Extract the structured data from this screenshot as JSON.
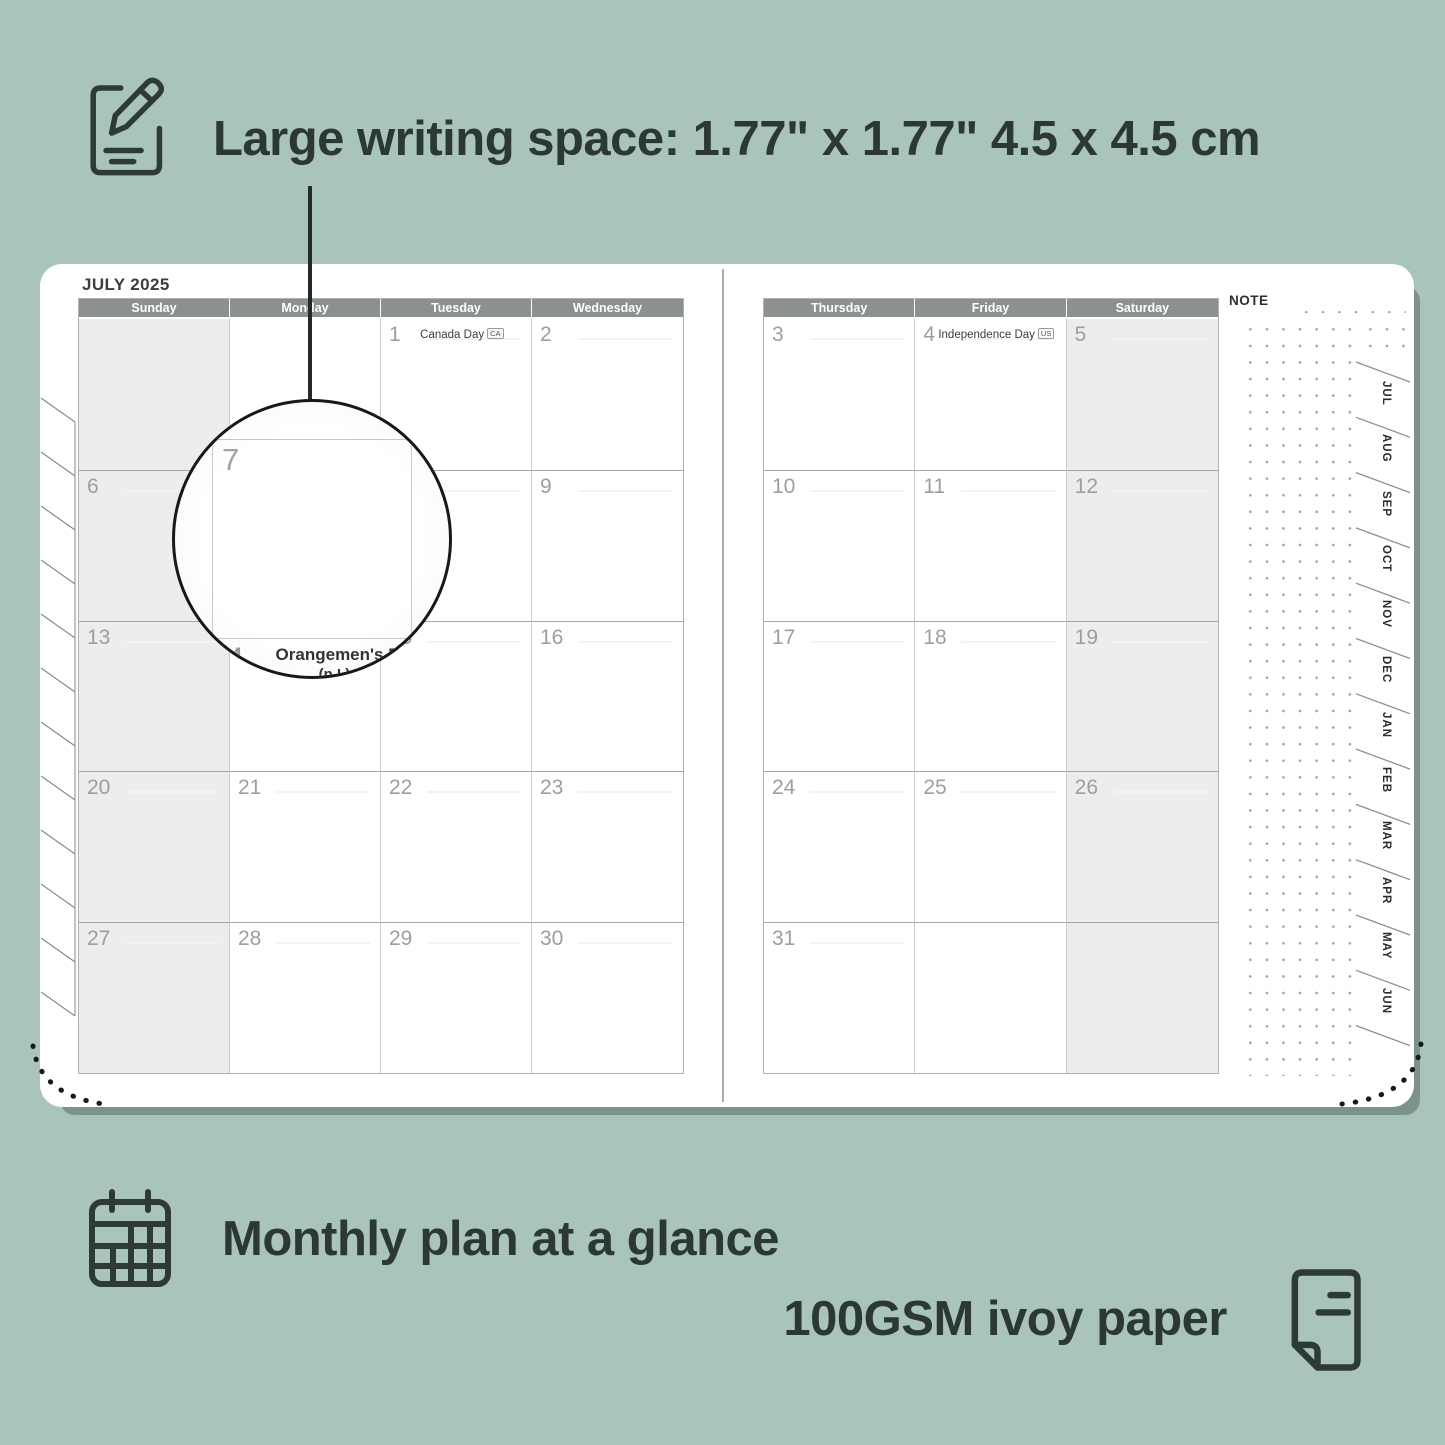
{
  "colors": {
    "background": "#a9c4bc",
    "ink": "#2e3a37",
    "header_bar": "#8b918e",
    "weekend_fill": "#ededed",
    "day_number": "#9e9e9e",
    "page": "#ffffff",
    "page_shadow": "#7c938c"
  },
  "annotations": {
    "top": {
      "icon": "note-pencil-icon",
      "label": "Large writing space: 1.77\" x 1.77\"  4.5 x 4.5 cm"
    },
    "bottom_left": {
      "icon": "calendar-grid-icon",
      "label": "Monthly plan at a glance"
    },
    "bottom_right": {
      "icon": "paper-sheet-icon",
      "label": "100GSM ivoy paper"
    }
  },
  "planner": {
    "month_title": "JULY 2025",
    "note_label": "NOTE",
    "left_day_headers": [
      "Sunday",
      "Monday",
      "Tuesday",
      "Wednesday"
    ],
    "right_day_headers": [
      "Thursday",
      "Friday",
      "Saturday"
    ],
    "left_weeks": [
      [
        {
          "day": "",
          "shaded": true
        },
        {
          "day": ""
        },
        {
          "day": "1",
          "holiday": "Canada Day",
          "badge": "CA"
        },
        {
          "day": "2"
        }
      ],
      [
        {
          "day": "6",
          "shaded": true
        },
        {
          "day": "7"
        },
        {
          "day": "8"
        },
        {
          "day": "9"
        }
      ],
      [
        {
          "day": "13",
          "shaded": true
        },
        {
          "day": "14",
          "holiday": "Orangemen's Day (n.I.)",
          "badge": "UK"
        },
        {
          "day": "15"
        },
        {
          "day": "16"
        }
      ],
      [
        {
          "day": "20",
          "shaded": true
        },
        {
          "day": "21"
        },
        {
          "day": "22"
        },
        {
          "day": "23"
        }
      ],
      [
        {
          "day": "27",
          "shaded": true
        },
        {
          "day": "28"
        },
        {
          "day": "29"
        },
        {
          "day": "30"
        }
      ]
    ],
    "right_weeks": [
      [
        {
          "day": "3"
        },
        {
          "day": "4",
          "holiday": "Independence Day",
          "badge": "US"
        },
        {
          "day": "5",
          "shaded": true
        }
      ],
      [
        {
          "day": "10"
        },
        {
          "day": "11"
        },
        {
          "day": "12",
          "shaded": true
        }
      ],
      [
        {
          "day": "17"
        },
        {
          "day": "18"
        },
        {
          "day": "19",
          "shaded": true
        }
      ],
      [
        {
          "day": "24"
        },
        {
          "day": "25"
        },
        {
          "day": "26",
          "shaded": true
        }
      ],
      [
        {
          "day": "31"
        },
        {
          "day": ""
        },
        {
          "day": "",
          "shaded": true
        }
      ]
    ],
    "month_tabs": [
      "JUL",
      "AUG",
      "SEP",
      "OCT",
      "NOV",
      "DEC",
      "JAN",
      "FEB",
      "MAR",
      "APR",
      "MAY",
      "JUN"
    ],
    "magnifier": {
      "enlarged_day": "7",
      "next_day": "4",
      "holiday_line1": "Orangemen's Day",
      "holiday_line2": "(n.I.)",
      "holiday_badge": "UK"
    }
  }
}
